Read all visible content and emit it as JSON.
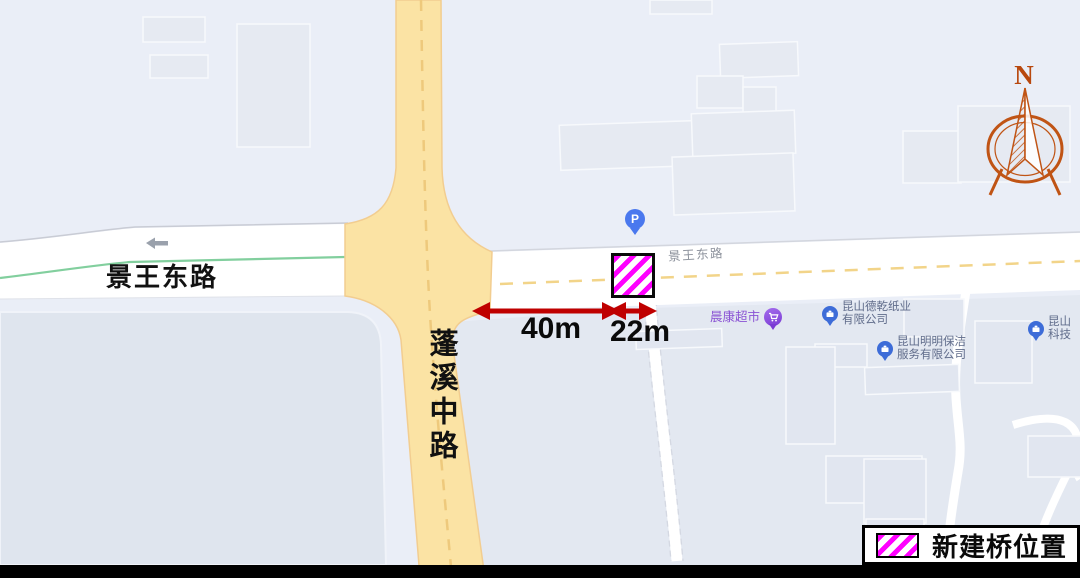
{
  "roads": {
    "jingwang_east_west_label": "景王东路",
    "jingwang_east_east_label": "景王东路",
    "pengxi_middle_label": "蓬溪中路"
  },
  "pois": [
    {
      "name": "晨康超市",
      "icon": "cart-icon"
    },
    {
      "name_line1": "昆山德乾纸业",
      "name_line2": "有限公司",
      "icon": "company-icon"
    },
    {
      "name_line1": "昆山明明保洁",
      "name_line2": "服务有限公司",
      "icon": "company-icon"
    },
    {
      "name_line1": "昆山",
      "name_line2": "科技",
      "icon": "company-icon"
    }
  ],
  "markers": {
    "parking_label": "P",
    "parking_icon": "parking-icon"
  },
  "measurements": {
    "west_gap": "40m",
    "bridge_width": "22m"
  },
  "legend": {
    "label": "新建桥位置"
  },
  "compass": {
    "label": "N"
  },
  "colors": {
    "background": "#eaeef7",
    "bridge_stripe": "#ff00ff",
    "measure_arrow": "#bf0000",
    "main_road_fill": "#fbe3a4",
    "road_center_dash": "#eec97c",
    "green_lane_line": "#82cf9e",
    "compass": "#c05415",
    "poi_company_text": "#5f6b8a",
    "poi_supermarket_text": "#8a52d4",
    "poi_pin_blue": "#3d6cd8",
    "poi_pin_purple": "#7a3bd4",
    "parking_pin_blue": "#4a78ee",
    "road_label_gray": "#8e939d",
    "southwest_parcel": "#dfe5ee",
    "southeast_parcel": "#e3e8f1"
  }
}
